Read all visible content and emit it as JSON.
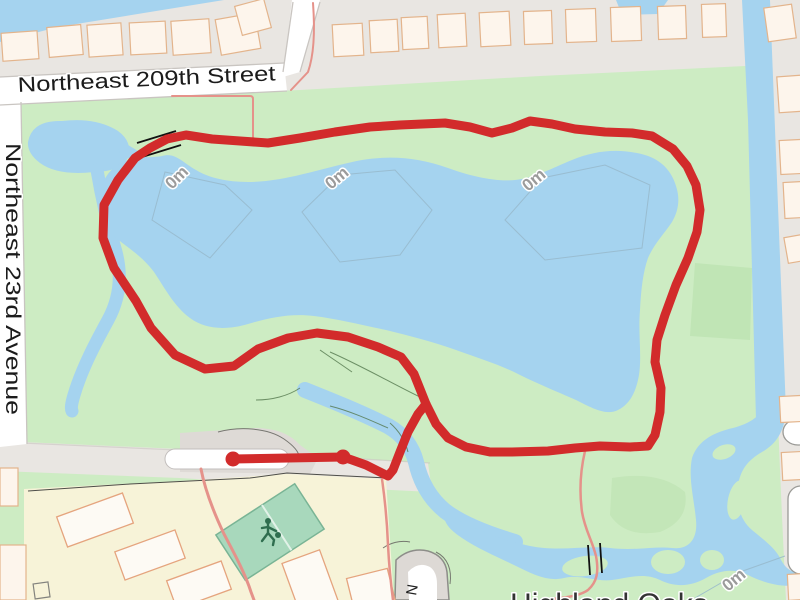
{
  "map": {
    "description": "Web map with a red GPS activity track looping around a lake in a park",
    "labels": {
      "street_top": "Northeast 209th Street",
      "street_left": "Northeast 23rd Avenue",
      "place": "Highland Oaks",
      "cul_de_sac_street": "N",
      "depth_contour": "0m"
    },
    "track": {
      "color": "#d22b2b",
      "marker_count": 2
    },
    "colors": {
      "water": "#a5d3ef",
      "park": "#cdecc3",
      "park_dark": "#c0e5b5",
      "residential": "#e9e6e2",
      "road_fill": "#ffffff",
      "road_casing": "#c9c5c1",
      "school": "#f7f3d8",
      "building": "#fdf5ec",
      "building_outline": "#e3b48c",
      "pitch": "#a8d8bc",
      "pitch_outline": "#79b495",
      "pitch_icon": "#2f6e4f",
      "minor_path": "#e5928a",
      "contour_line": "#96b8cb",
      "label_dark": "#1b1b1b",
      "label_gray": "#9b9b9b"
    }
  }
}
